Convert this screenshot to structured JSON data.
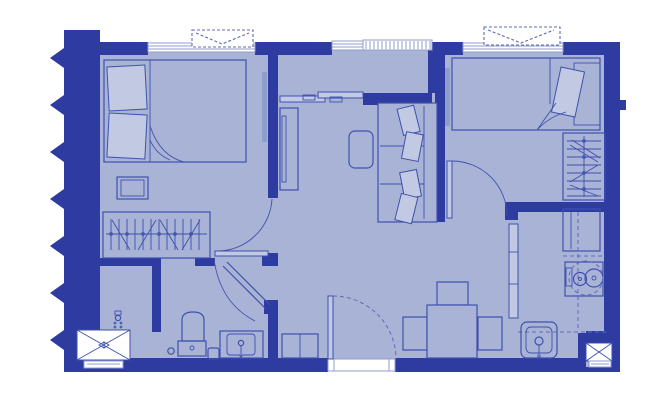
{
  "meta": {
    "title": "two-bedroom-apartment-floor-plan",
    "canvas": {
      "width": 645,
      "height": 414
    },
    "visible_text": []
  },
  "colors": {
    "wall": "#2e3ba0",
    "floor": "#a9b3d6",
    "line": "#3f51ad",
    "soft": "#8f9dcb",
    "light": "#c2c9e2",
    "dash": "#5d6cb6",
    "white": "#ffffff"
  },
  "rooms": [
    {
      "name": "bedroom-1",
      "position": "top-left",
      "furniture": [
        "double-bed",
        "two-pillows",
        "blanket-fold",
        "nightstand",
        "wardrobe-with-hangers",
        "ac-indoor-unit",
        "window",
        "ac-outdoor-unit",
        "swing-door"
      ]
    },
    {
      "name": "bedroom-2",
      "position": "top-right",
      "furniture": [
        "single-bed",
        "pillow",
        "blanket-fold",
        "headboard-panel",
        "wardrobe-with-hangers",
        "ac-indoor-unit",
        "window",
        "ac-outdoor-unit",
        "swing-door"
      ]
    },
    {
      "name": "living-dining",
      "position": "center",
      "furniture": [
        "sofa-with-cushions",
        "coffee-table",
        "tv-console",
        "sliding-balcony-door",
        "dining-table",
        "three-dining-chairs",
        "shoe-cabinet",
        "entry-door-with-threshold"
      ]
    },
    {
      "name": "kitchen",
      "position": "bottom-right",
      "furniture": [
        "refrigerator",
        "two-burner-cooktop",
        "overhead-cabinet-dashed",
        "kitchen-sink-with-faucet",
        "tall-cabinet",
        "service-shaft-x-box"
      ]
    },
    {
      "name": "bathroom",
      "position": "bottom-left",
      "furniture": [
        "shower-area-x-box",
        "shower-head",
        "partition-wall",
        "toilet",
        "floor-drain",
        "waste-bin",
        "vanity-sink-with-faucet",
        "diagonal-swing-door"
      ]
    },
    {
      "name": "balcony-strip",
      "position": "top-center",
      "furniture": [
        "louver-railing-window",
        "sliding-door-panels"
      ]
    }
  ],
  "symbols": {
    "left_edge": "sawtooth-party-wall-break",
    "windows_count": 3,
    "ac_outdoor_units_count": 2,
    "x_shaft_boxes_count": 2,
    "door_arcs_count": 4
  }
}
